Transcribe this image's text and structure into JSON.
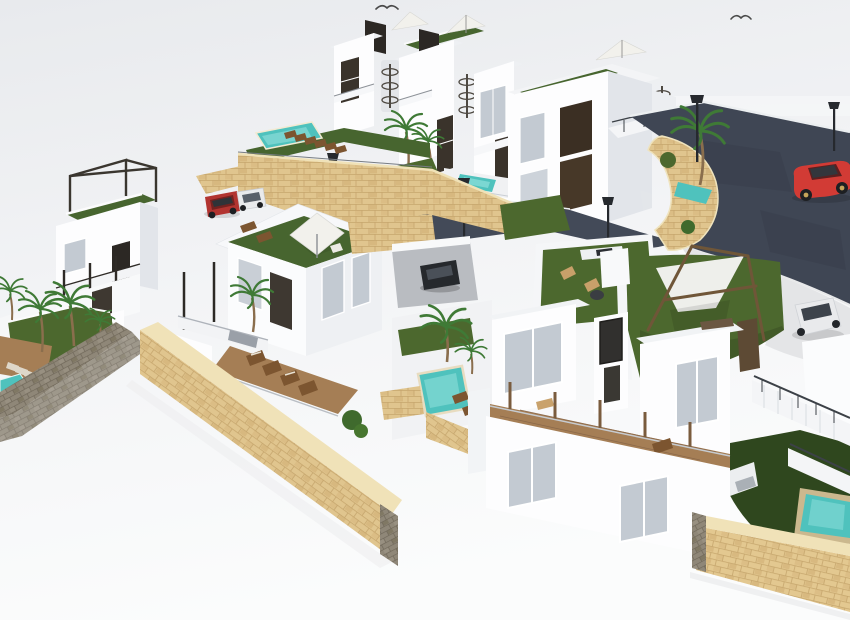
{
  "scene": {
    "description": "Aerial 3D architectural rendering of a hillside development of modern white villas with rooftop lawns and parasols, turquoise pools, sandstone retaining walls, palm trees, a dark curved asphalt road with street lamps, parked cars and sun-lounger terraces. Lower-left of the frame is empty white ground.",
    "element_counts": {
      "villas": 7,
      "pools": 6,
      "palm_trees": 12,
      "street_lamps": 5,
      "parasols": 3,
      "birds": 2
    },
    "cars": [
      "red sports car on road",
      "white suv on driveway",
      "red suv parked",
      "white car parked",
      "black car in courtyard"
    ]
  },
  "colors": {
    "sky_top": "#e8eaed",
    "sky_mid": "#f3f4f6",
    "sky_bottom": "#fbfcfc",
    "building_white": "#fdfdfe",
    "building_shade": "#e2e5ea",
    "building_roof": "#f1f3f5",
    "roof_turf": "#47652f",
    "lawn": "#4c682e",
    "lawn_dark": "#2f471e",
    "pool_water": "#4fc2bd",
    "pool_water_light": "#9ae4e0",
    "stone_sand": "#e0c58e",
    "stone_sand_joint": "#c6a66d",
    "stone_sand_cap": "#f0e2b8",
    "stone_gray": "#8f8778",
    "stone_gray_joint": "#6f6759",
    "road_asphalt": "#3f4654",
    "curb": "#eceff1",
    "pavement": "#e4e5e7",
    "wood_deck": "#a57e55",
    "wood_beam": "#6f5638",
    "dark_panel": "#2c2824",
    "window_glass": "#c3cad2",
    "window_dark": "#3a332b",
    "red_car": "#d23b35",
    "red_suv": "#b23430",
    "white_car": "#e9eaec",
    "dark_car": "#26292d",
    "lamp_post": "#26292e",
    "palm_frond": "#3f7a36",
    "palm_trunk": "#8a6e4d",
    "parasol": "#f2f1ec",
    "lounger_brown": "#7c5530",
    "lounger_pale": "#ded7c9",
    "railing": "#3c4147",
    "bird": "#4a4a4a"
  }
}
